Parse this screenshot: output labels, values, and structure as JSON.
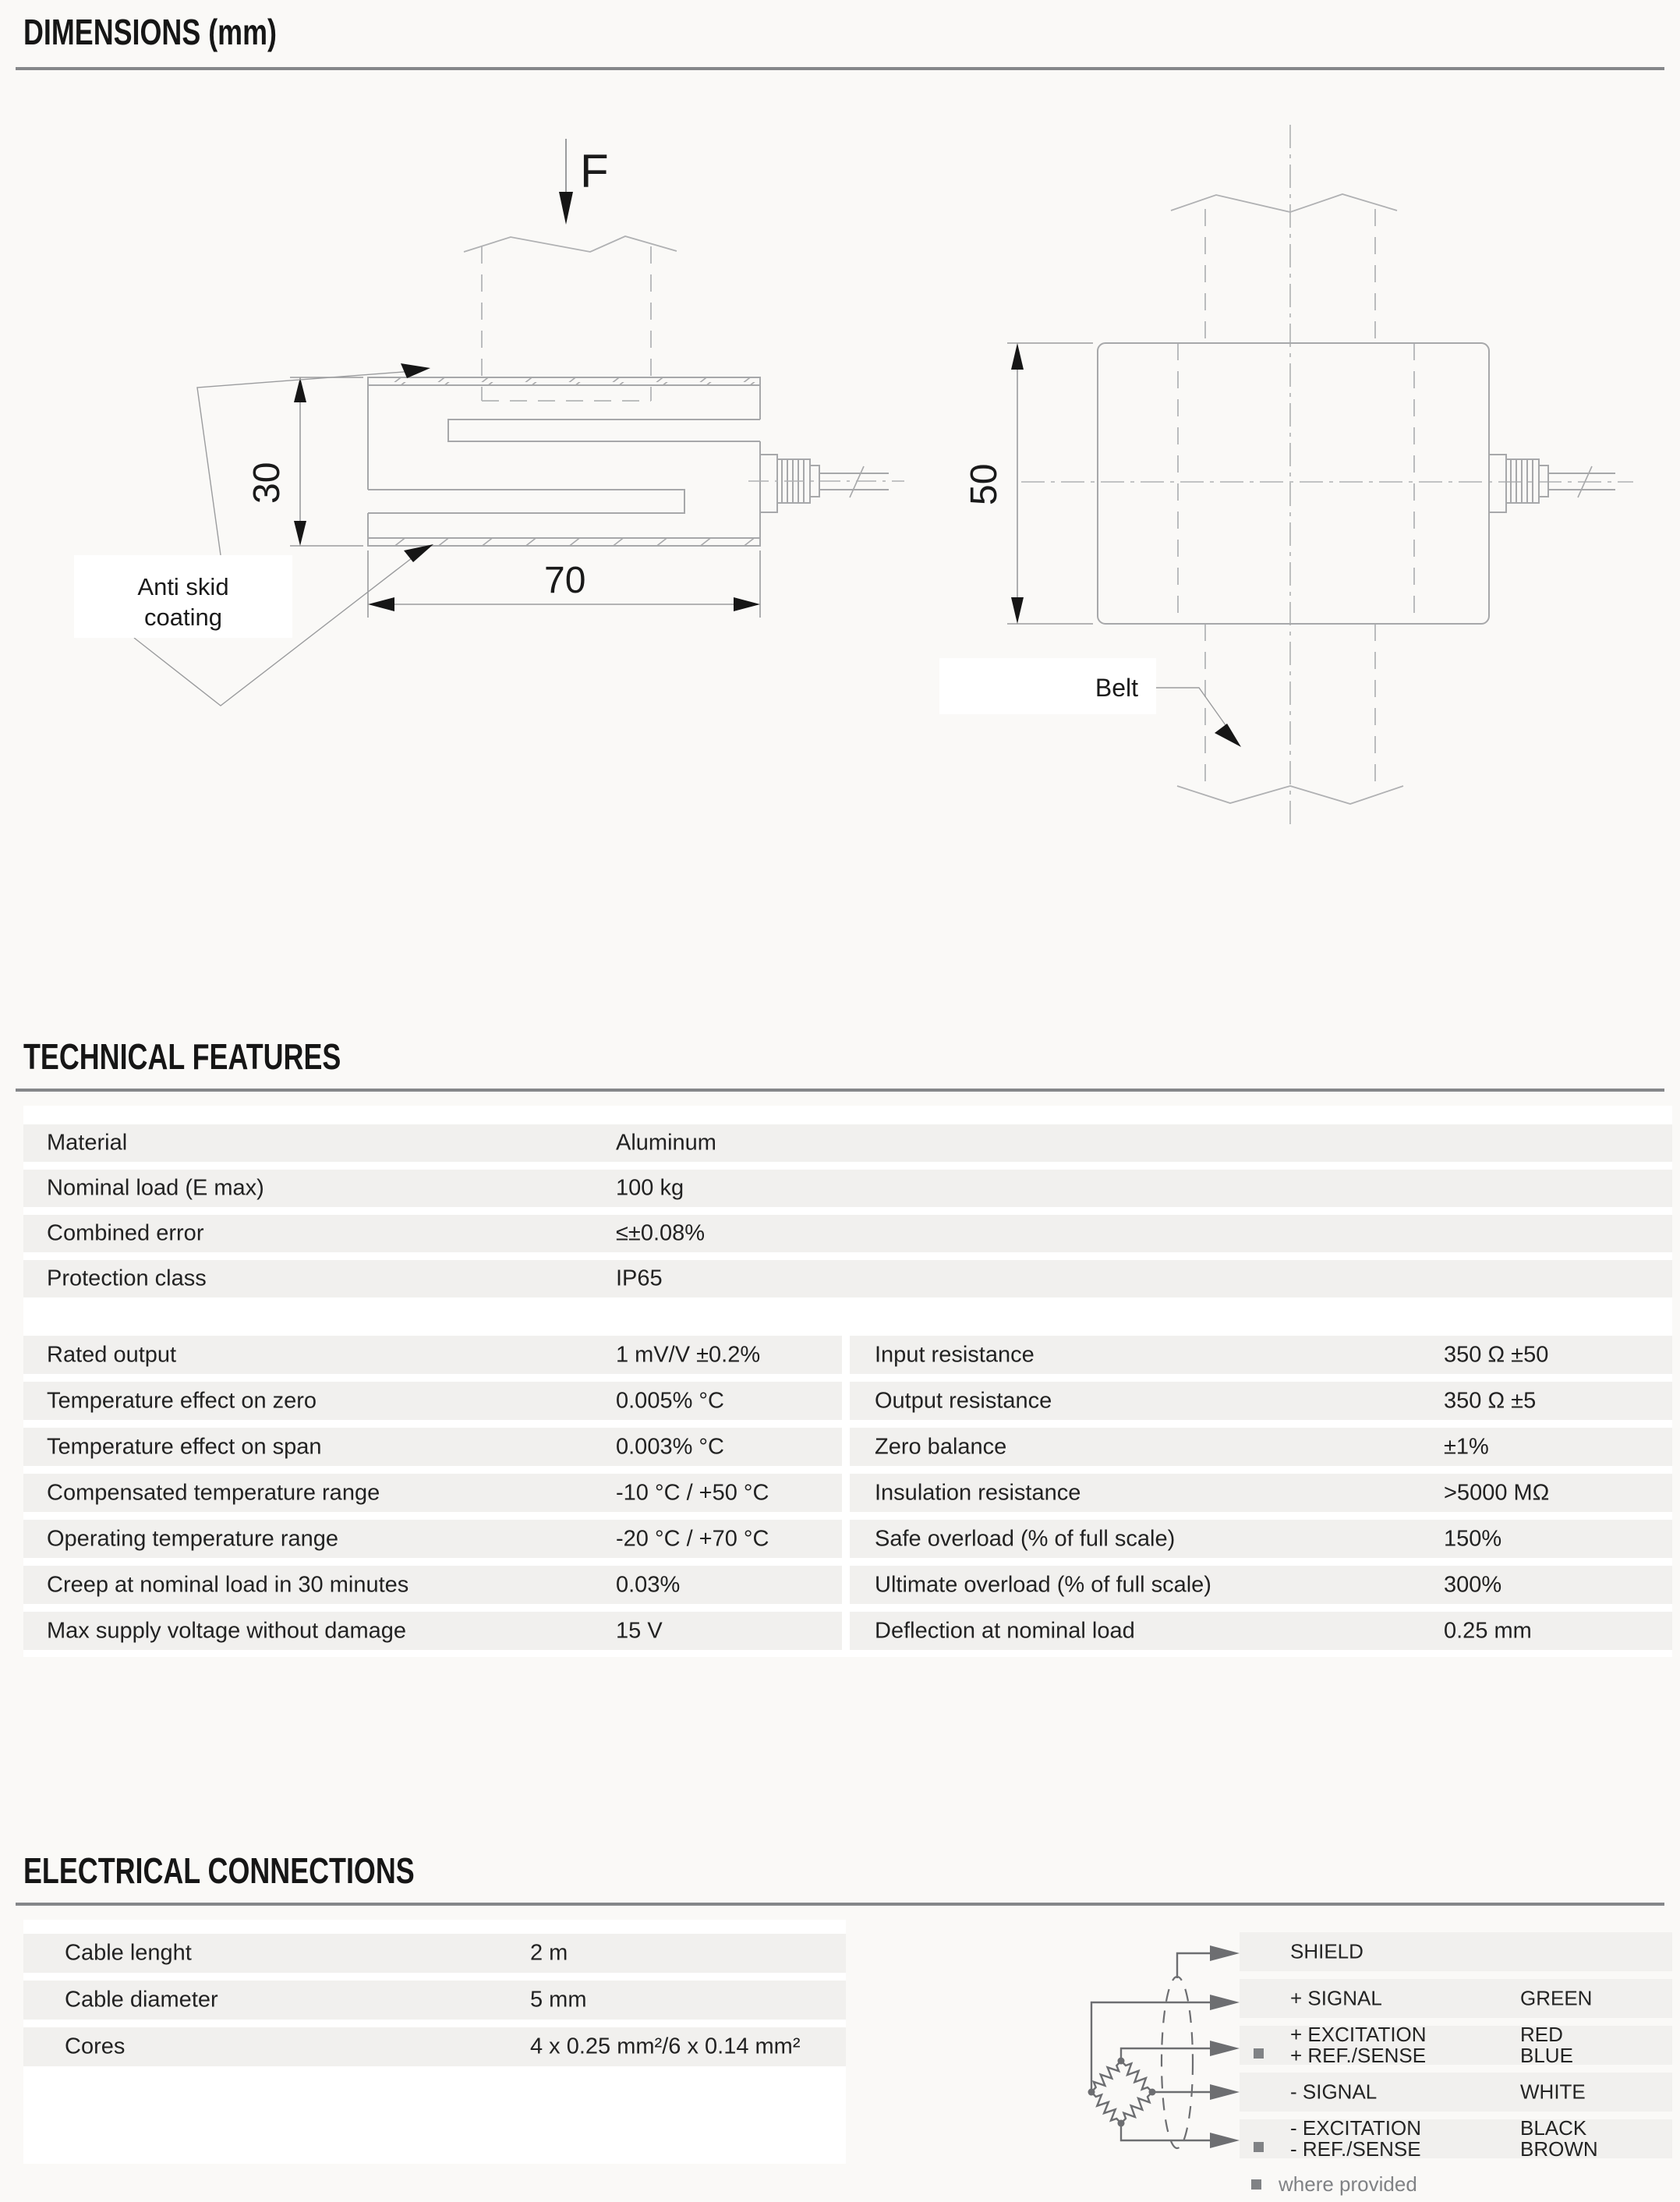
{
  "sections": {
    "dimensions_title": "DIMENSIONS (mm)",
    "technical_title": "TECHNICAL FEATURES",
    "electrical_title": "ELECTRICAL CONNECTIONS"
  },
  "drawings": {
    "side_view": {
      "force_label": "F",
      "height_dim": "30",
      "width_dim": "70",
      "coating_line1": "Anti skid",
      "coating_line2": "coating"
    },
    "front_view": {
      "height_dim": "50",
      "belt_label": "Belt"
    }
  },
  "technical_table": {
    "general": [
      {
        "label": "Material",
        "value": "Aluminum"
      },
      {
        "label": "Nominal load (E max)",
        "value": "100 kg"
      },
      {
        "label": "Combined error",
        "value": "≤±0.08%"
      },
      {
        "label": "Protection class",
        "value": "IP65"
      }
    ],
    "left": [
      {
        "label": "Rated output",
        "value": "1 mV/V ±0.2%"
      },
      {
        "label": "Temperature effect on zero",
        "value": "0.005% °C"
      },
      {
        "label": "Temperature effect on span",
        "value": "0.003% °C"
      },
      {
        "label": "Compensated temperature range",
        "value": "-10 °C / +50 °C"
      },
      {
        "label": "Operating temperature range",
        "value": "-20 °C / +70 °C"
      },
      {
        "label": "Creep at nominal load in 30 minutes",
        "value": "0.03%"
      },
      {
        "label": "Max supply voltage without damage",
        "value": "15 V"
      }
    ],
    "right": [
      {
        "label": "Input resistance",
        "value": "350 Ω ±50"
      },
      {
        "label": "Output resistance",
        "value": "350 Ω ±5"
      },
      {
        "label": "Zero balance",
        "value": "±1%"
      },
      {
        "label": "Insulation resistance",
        "value": ">5000 MΩ"
      },
      {
        "label": "Safe overload (% of full scale)",
        "value": "150%"
      },
      {
        "label": "Ultimate overload (% of full scale)",
        "value": "300%"
      },
      {
        "label": "Deflection at nominal load",
        "value": "0.25 mm"
      }
    ]
  },
  "electrical_table": [
    {
      "label": "Cable lenght",
      "value": "2 m"
    },
    {
      "label": "Cable diameter",
      "value": "5 mm"
    },
    {
      "label": "Cores",
      "value": "4 x 0.25 mm²/6 x 0.14 mm²"
    }
  ],
  "wiring": {
    "rows": [
      {
        "labels": [
          "SHIELD"
        ],
        "colors": []
      },
      {
        "labels": [
          "+ SIGNAL"
        ],
        "colors": [
          "GREEN"
        ]
      },
      {
        "labels": [
          "+ EXCITATION",
          "+ REF./SENSE"
        ],
        "colors": [
          "RED",
          "BLUE"
        ]
      },
      {
        "labels": [
          "- SIGNAL"
        ],
        "colors": [
          "WHITE"
        ]
      },
      {
        "labels": [
          "- EXCITATION",
          "- REF./SENSE"
        ],
        "colors": [
          "BLACK",
          "BROWN"
        ]
      }
    ],
    "footnote": "where provided"
  },
  "colors": {
    "page_bg": "#faf9f7",
    "row_bg": "#f1f0ee",
    "rule": "#85878a",
    "drawing_line": "#a7a8aa",
    "bridge_line": "#6d6e71",
    "footnote_gray": "#808285",
    "text": "#1e1e1e"
  }
}
